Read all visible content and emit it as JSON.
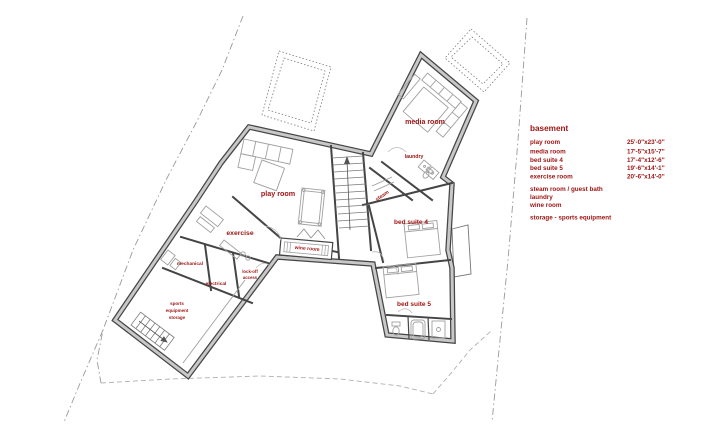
{
  "colors": {
    "label_red": "#9e1212",
    "wall_dark": "#454545",
    "wall_gray": "#c8c8c8",
    "furniture_gray": "#a0a0a0",
    "property_line": "#999999"
  },
  "rooms": {
    "play_room": "play room",
    "media_room": "media room",
    "laundry": "laundry",
    "steam": "steam",
    "bed_suite_4": "bed suite 4",
    "bed_suite_5": "bed suite 5",
    "exercise": "exercise",
    "mechanical": "mechanical",
    "electrical": "electrical",
    "wine_room": "wine room",
    "lock_off": [
      "lock-off",
      "access"
    ],
    "storage": [
      "sports",
      "equipment",
      "storage"
    ]
  },
  "legend": {
    "title": "basement",
    "items": [
      {
        "name": "play room",
        "dims": "25'-0\"x23'-0\""
      },
      {
        "name": "media room",
        "dims": "17'-5\"x15'-7\""
      },
      {
        "name": "bed suite 4",
        "dims": "17'-4\"x12'-6\""
      },
      {
        "name": "bed suite 5",
        "dims": "19'-6\"x14'-1\""
      },
      {
        "name": "exercise room",
        "dims": "20'-6\"x14'-0\""
      },
      {
        "name": "steam room / guest bath",
        "dims": ""
      },
      {
        "name": "laundry",
        "dims": ""
      },
      {
        "name": "wine room",
        "dims": ""
      },
      {
        "name": "storage - sports equipment",
        "dims": ""
      }
    ]
  }
}
